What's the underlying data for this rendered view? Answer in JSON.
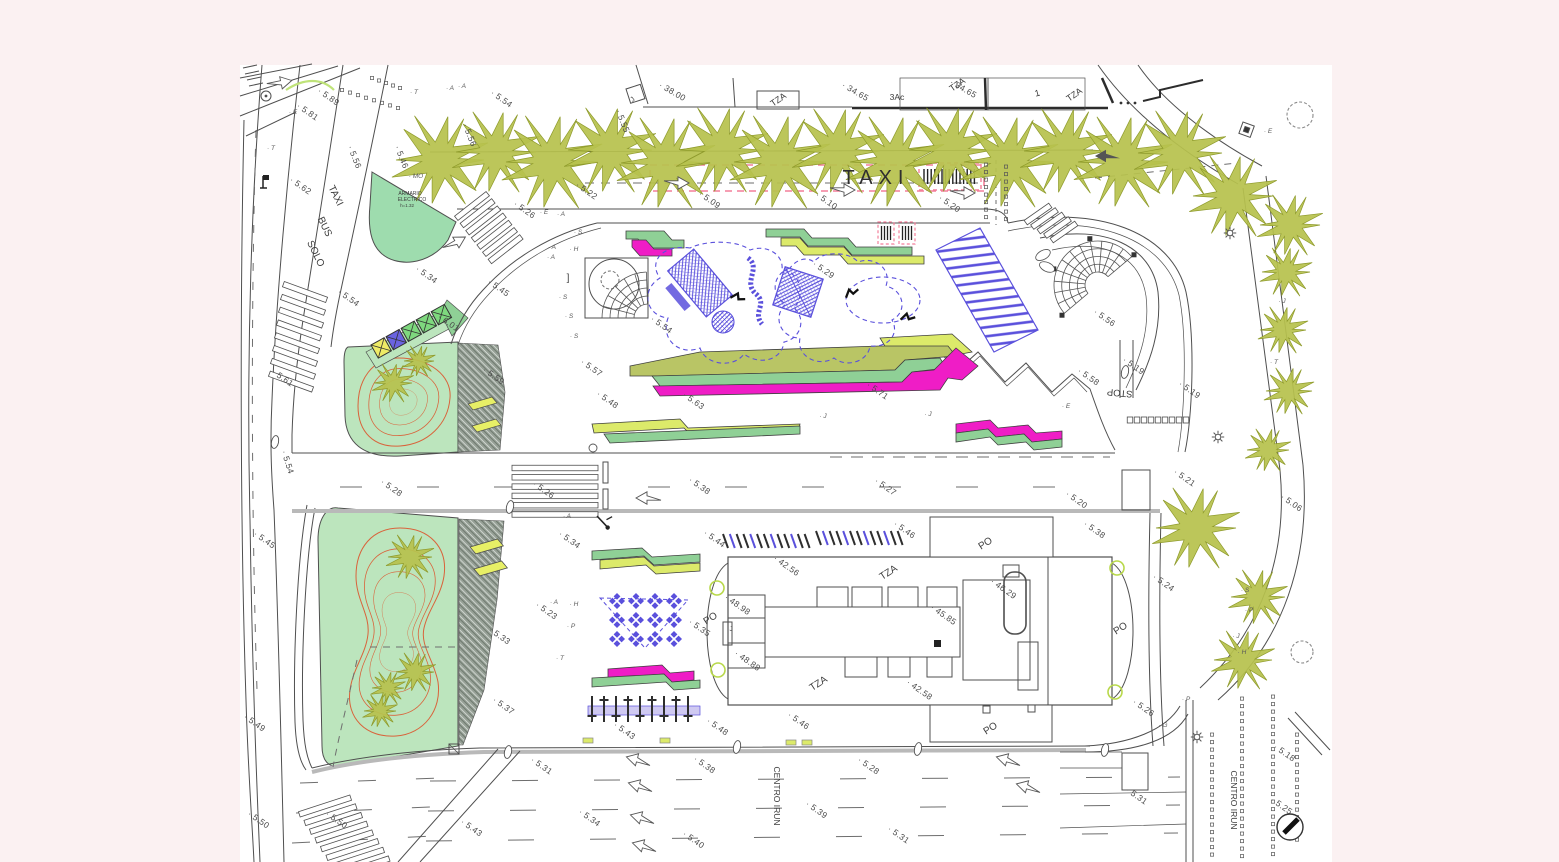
{
  "drawing": {
    "type": "architectural site plan",
    "description": "CAD site plan of an urban park, taxi/bus zone, playground and building with porticos"
  },
  "colors": {
    "bg": "#fbf1f2",
    "paper": "#ffffff",
    "line": "#4f4f4f",
    "roadGrey": "#b9b9b9",
    "tree": "#b7c24d",
    "treeEdge": "#8e9a2b",
    "lawn": "#bce5bd",
    "mint": "#9edcae",
    "hatch": "#96a096",
    "contour": "#d9633b",
    "blue": "#5a50dc",
    "magenta": "#ef1dc6",
    "bandGreen": "#8fd096",
    "bandYellow": "#dcea6a",
    "bandOlive": "#b9c565",
    "lavender": "#cfc9f1",
    "pink": "#f47e9a",
    "chevron": "#e7ef66",
    "containerYellow": "#eeeb66",
    "containerBlue": "#6a63e0",
    "containerGreen": "#7ed87e",
    "spotText": "#4a4a4a",
    "letterText": "#5a5a5a"
  },
  "text_labels": [
    {
      "t": "TAXI",
      "x": 876,
      "y": 184,
      "r": 0,
      "s": 20,
      "ls": 6,
      "c": "#2f2f2f",
      "n": "taxi-zone-label"
    },
    {
      "t": "TAXI",
      "x": 333,
      "y": 197,
      "r": 64,
      "s": 10,
      "n": "taxi-lane-word-1"
    },
    {
      "t": "BUS",
      "x": 322,
      "y": 228,
      "r": 64,
      "s": 10,
      "n": "taxi-lane-word-2"
    },
    {
      "t": "SOLO",
      "x": 313,
      "y": 255,
      "r": 64,
      "s": 10,
      "n": "taxi-lane-word-3"
    },
    {
      "t": "ARMARIO",
      "x": 410,
      "y": 195,
      "r": 0,
      "s": 5,
      "n": "armario-electrico-line1"
    },
    {
      "t": "ELECTRICO",
      "x": 412,
      "y": 201,
      "r": 0,
      "s": 5,
      "n": "armario-electrico-line2"
    },
    {
      "t": "h=1.32",
      "x": 407,
      "y": 207,
      "r": 0,
      "s": 4.5,
      "n": "armario-electrico-line3"
    },
    {
      "t": "STOP",
      "x": 1120,
      "y": 390,
      "r": 185,
      "s": 9.5,
      "c": "#3a3a3a",
      "n": "stop-marking"
    },
    {
      "t": "CENTRO IRUN",
      "x": 774,
      "y": 796,
      "r": 90,
      "s": 8.5,
      "n": "street-name-centro-irun-1"
    },
    {
      "t": "CENTRO IRUN",
      "x": 1231,
      "y": 800,
      "r": 90,
      "s": 8.5,
      "n": "street-name-centro-irun-2"
    },
    {
      "t": "TZA",
      "x": 780,
      "y": 102,
      "r": -35,
      "s": 9,
      "n": "bldg-tza-1"
    },
    {
      "t": "TZA",
      "x": 959,
      "y": 87,
      "r": -35,
      "s": 9,
      "n": "bldg-tza-2"
    },
    {
      "t": "TZA",
      "x": 1076,
      "y": 97,
      "r": -35,
      "s": 9,
      "n": "bldg-tza-3"
    },
    {
      "t": "3Ac",
      "x": 897,
      "y": 100,
      "r": 0,
      "s": 8.5,
      "n": "bldg-3ac"
    },
    {
      "t": "1",
      "x": 1038,
      "y": 96,
      "r": -15,
      "s": 9,
      "n": "bldg-1"
    },
    {
      "t": "TZA",
      "x": 890,
      "y": 575,
      "r": -33,
      "s": 10,
      "n": "building-tza-top"
    },
    {
      "t": "TZA",
      "x": 820,
      "y": 686,
      "r": -33,
      "s": 10,
      "n": "building-tza-bottom"
    },
    {
      "t": "PO",
      "x": 987,
      "y": 546,
      "r": -33,
      "s": 10,
      "n": "portico-top"
    },
    {
      "t": "PO",
      "x": 992,
      "y": 731,
      "r": -33,
      "s": 10,
      "n": "portico-bottom"
    },
    {
      "t": "PO",
      "x": 712,
      "y": 621,
      "r": -33,
      "s": 10,
      "n": "portico-left"
    },
    {
      "t": "PO",
      "x": 1122,
      "y": 631,
      "r": -33,
      "s": 10,
      "n": "portico-right"
    },
    {
      "t": "]",
      "x": 568,
      "y": 281,
      "r": 0,
      "s": 10,
      "n": "bracket-mark"
    },
    {
      "t": "J",
      "x": 634,
      "y": 101,
      "r": -40,
      "s": 7,
      "n": "survey-j-top"
    },
    {
      "t": "J",
      "x": 731,
      "y": 631,
      "r": 0,
      "s": 6,
      "n": "survey-j-building"
    }
  ],
  "spot_elevations": [
    [
      "5.89",
      327,
      99
    ],
    [
      "5.81",
      306,
      114
    ],
    [
      "5.54",
      500,
      101
    ],
    [
      "5.62",
      299,
      188
    ],
    [
      "5.56",
      352,
      158,
      68
    ],
    [
      "5.46",
      399,
      158,
      68
    ],
    [
      "5.56",
      467,
      136,
      68
    ],
    [
      "5.55",
      620,
      122,
      68
    ],
    [
      "5.22",
      585,
      193
    ],
    [
      "5.09",
      708,
      202
    ],
    [
      "5.10",
      825,
      203
    ],
    [
      "5.20",
      948,
      206
    ],
    [
      "5.26",
      523,
      212
    ],
    [
      "5.54",
      347,
      300
    ],
    [
      "5.34",
      425,
      277
    ],
    [
      "5.45",
      497,
      290
    ],
    [
      "6.01",
      447,
      325
    ],
    [
      "5.59",
      492,
      378
    ],
    [
      "5.61",
      281,
      380
    ],
    [
      "5.54",
      285,
      463,
      72
    ],
    [
      "5.45",
      263,
      542
    ],
    [
      "5.28",
      390,
      490
    ],
    [
      "5.57",
      590,
      370
    ],
    [
      "5.48",
      606,
      402
    ],
    [
      "5.63",
      692,
      403
    ],
    [
      "5.71",
      876,
      393
    ],
    [
      "5.54",
      660,
      327
    ],
    [
      "5.29",
      822,
      272
    ],
    [
      "5.56",
      1103,
      320
    ],
    [
      "5.58",
      1087,
      379
    ],
    [
      "5.19",
      1132,
      368
    ],
    [
      "5.19",
      1188,
      392
    ],
    [
      "5.26",
      542,
      492
    ],
    [
      "5.38",
      698,
      488
    ],
    [
      "5.27",
      884,
      489
    ],
    [
      "5.20",
      1075,
      502
    ],
    [
      "5.21",
      1183,
      480
    ],
    [
      "5.06",
      1290,
      505
    ],
    [
      "5.44",
      713,
      541
    ],
    [
      "5.46",
      903,
      532
    ],
    [
      "5.38",
      1093,
      532
    ],
    [
      "5.34",
      568,
      542
    ],
    [
      "5.23",
      545,
      613
    ],
    [
      "5.33",
      498,
      638
    ],
    [
      "5.35",
      698,
      630
    ],
    [
      "5.24",
      1162,
      585
    ],
    [
      "42.56",
      785,
      568
    ],
    [
      "48.98",
      736,
      607
    ],
    [
      "48.88",
      746,
      663
    ],
    [
      "45.85",
      942,
      617
    ],
    [
      "46.29",
      1002,
      591
    ],
    [
      "42.58",
      918,
      692
    ],
    [
      "5.37",
      502,
      708
    ],
    [
      "5.43",
      623,
      733
    ],
    [
      "5.48",
      716,
      729
    ],
    [
      "5.46",
      797,
      723
    ],
    [
      "5.26",
      1142,
      710
    ],
    [
      "5.49",
      253,
      725
    ],
    [
      "5.50",
      257,
      822
    ],
    [
      "5.50",
      335,
      822
    ],
    [
      "5.43",
      470,
      830
    ],
    [
      "5.31",
      540,
      768
    ],
    [
      "5.34",
      588,
      820
    ],
    [
      "5.38",
      703,
      767
    ],
    [
      "5.40",
      692,
      842
    ],
    [
      "5.28",
      867,
      768
    ],
    [
      "5.39",
      815,
      812
    ],
    [
      "5.31",
      897,
      837
    ],
    [
      "5.31",
      1135,
      798
    ],
    [
      "5.25",
      1280,
      808
    ],
    [
      "5.18",
      1283,
      755
    ],
    [
      "38.00",
      671,
      94,
      30
    ],
    [
      "34.65",
      854,
      94,
      30
    ],
    [
      "34.65",
      962,
      91,
      30
    ]
  ],
  "point_letters": [
    [
      "A",
      450,
      90
    ],
    [
      "A",
      462,
      88
    ],
    [
      "T",
      414,
      94
    ],
    [
      "E",
      293,
      114
    ],
    [
      "T",
      271,
      150
    ],
    [
      "MO",
      416,
      178
    ],
    [
      "E",
      544,
      214
    ],
    [
      "A",
      561,
      216
    ],
    [
      "S",
      578,
      234
    ],
    [
      "A",
      552,
      249
    ],
    [
      "H",
      574,
      251
    ],
    [
      "A",
      551,
      259
    ],
    [
      "S",
      563,
      299
    ],
    [
      "S",
      569,
      318
    ],
    [
      "S",
      574,
      338
    ],
    [
      "J",
      823,
      418
    ],
    [
      "J",
      928,
      416
    ],
    [
      "E",
      1066,
      408
    ],
    [
      "E",
      1268,
      133
    ],
    [
      "J",
      1282,
      303
    ],
    [
      "T",
      1274,
      364
    ],
    [
      "P",
      1186,
      701
    ],
    [
      "G",
      1163,
      727
    ],
    [
      "A",
      554,
      604
    ],
    [
      "H",
      574,
      606
    ],
    [
      "P",
      571,
      628
    ],
    [
      "T",
      560,
      660
    ],
    [
      "A",
      567,
      518
    ],
    [
      "S",
      1245,
      592
    ],
    [
      "P",
      1249,
      612
    ],
    [
      "J",
      1236,
      638
    ],
    [
      "H",
      1242,
      654
    ]
  ],
  "trees": [
    [
      440,
      160,
      44
    ],
    [
      496,
      152,
      40
    ],
    [
      552,
      162,
      46
    ],
    [
      610,
      150,
      42
    ],
    [
      666,
      163,
      45
    ],
    [
      722,
      150,
      42
    ],
    [
      780,
      162,
      46
    ],
    [
      838,
      151,
      42
    ],
    [
      895,
      162,
      45
    ],
    [
      951,
      150,
      42
    ],
    [
      1009,
      162,
      45
    ],
    [
      1066,
      151,
      42
    ],
    [
      1123,
      162,
      45
    ],
    [
      1180,
      153,
      42
    ],
    [
      1233,
      196,
      40
    ],
    [
      1290,
      225,
      30
    ],
    [
      1286,
      272,
      24
    ],
    [
      1283,
      330,
      23
    ],
    [
      1289,
      391,
      23
    ],
    [
      1268,
      450,
      21
    ],
    [
      1196,
      528,
      40
    ],
    [
      1258,
      597,
      27
    ],
    [
      1243,
      660,
      29
    ],
    [
      393,
      383,
      19
    ],
    [
      419,
      361,
      15
    ],
    [
      410,
      557,
      22
    ],
    [
      415,
      672,
      19
    ],
    [
      388,
      688,
      16
    ],
    [
      380,
      711,
      16
    ]
  ],
  "cloud_trees": [
    [
      1300,
      115,
      13
    ],
    [
      1302,
      652,
      11
    ]
  ],
  "lamps": [
    [
      1230,
      233
    ],
    [
      1218,
      437
    ],
    [
      1197,
      737
    ]
  ],
  "survey_ovals": [
    [
      275,
      442
    ],
    [
      510,
      507
    ],
    [
      508,
      752
    ],
    [
      737,
      747
    ],
    [
      918,
      749
    ],
    [
      1105,
      750
    ],
    [
      1125,
      372
    ]
  ],
  "picnic_tables": {
    "cols": 4,
    "rows": 3,
    "x0": 617,
    "y0": 601,
    "dx": 19,
    "dy": 19
  },
  "bike_racks": [
    {
      "x": 723,
      "y": 534,
      "n": 13
    },
    {
      "x": 816,
      "y": 531,
      "n": 13
    }
  ],
  "fitness_row": {
    "x": 592,
    "y": 708,
    "n": 9,
    "dx": 12
  },
  "road_marker_rects": [
    [
      583,
      738
    ],
    [
      660,
      738
    ],
    [
      786,
      740
    ],
    [
      802,
      740
    ]
  ],
  "dotted_columns": [
    {
      "x": 986,
      "y0": 163,
      "y1": 222
    },
    {
      "x": 1006,
      "y0": 165,
      "y1": 223
    },
    {
      "x": 1212,
      "y0": 733,
      "y1": 858
    },
    {
      "x": 1242,
      "y0": 697,
      "y1": 860
    },
    {
      "x": 1273,
      "y0": 695,
      "y1": 858
    },
    {
      "x": 1297,
      "y0": 733,
      "y1": 845
    }
  ],
  "dotted_diagonals": [
    {
      "x0": 342,
      "y0": 90,
      "x1": 398,
      "y1": 108,
      "n": 8
    },
    {
      "x0": 372,
      "y0": 78,
      "x1": 400,
      "y1": 88,
      "n": 5
    }
  ]
}
